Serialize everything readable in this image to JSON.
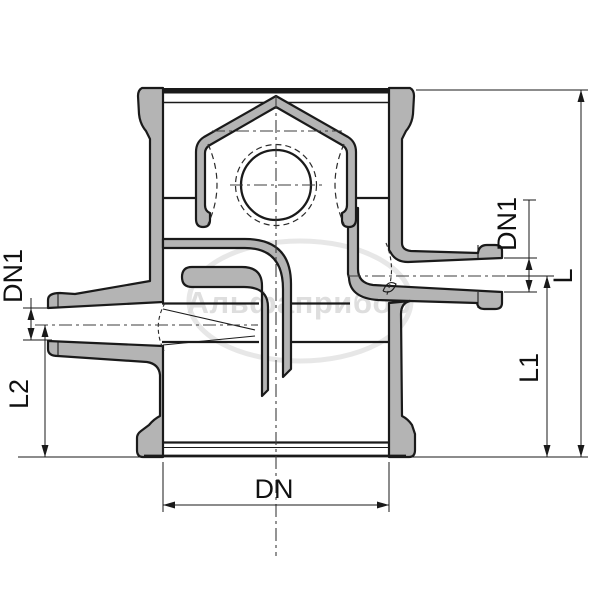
{
  "watermark": {
    "text": "Альфаприбор"
  },
  "labels": {
    "dn": "DN",
    "dn1_left": "DN1",
    "dn1_right": "DN1",
    "l": "L",
    "l1": "L1",
    "l2": "L2"
  },
  "colors": {
    "outline": "#1a1a1a",
    "cast_fill": "#b4b4b4",
    "background": "#ffffff",
    "watermark_ellipse": "#e7e7e7",
    "watermark_text": "#dedede"
  }
}
